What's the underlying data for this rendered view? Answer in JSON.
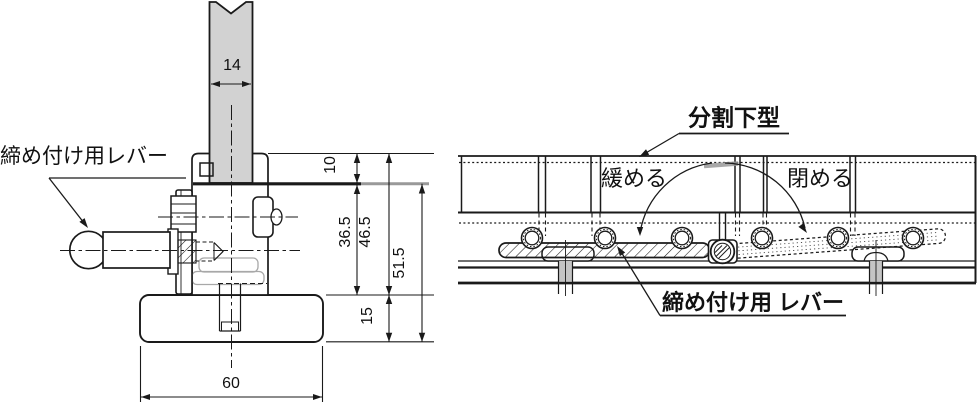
{
  "figure": {
    "kind": "technical-drawing",
    "subject": "press-brake split lower die clamping lever",
    "views": [
      "front-section-view",
      "side-view"
    ]
  },
  "colors": {
    "line": "#1a1a1a",
    "punch_fill": "#d2d2d2",
    "ghost_line": "#a8a8a8",
    "gray_dim_line": "#999999",
    "background": "#ffffff"
  },
  "left_view": {
    "lever_label": "締め付け用レバー",
    "dims": {
      "punch_width": "14",
      "top_offset": "10",
      "mid_height": "36.5",
      "upper_total": "46.5",
      "lower_total": "51.5",
      "base_height": "15",
      "base_width": "60"
    }
  },
  "right_view": {
    "split_die_label": "分割下型",
    "loosen_label": "緩める",
    "close_label": "閉める",
    "lever_label": "締め付け用 レバー"
  }
}
